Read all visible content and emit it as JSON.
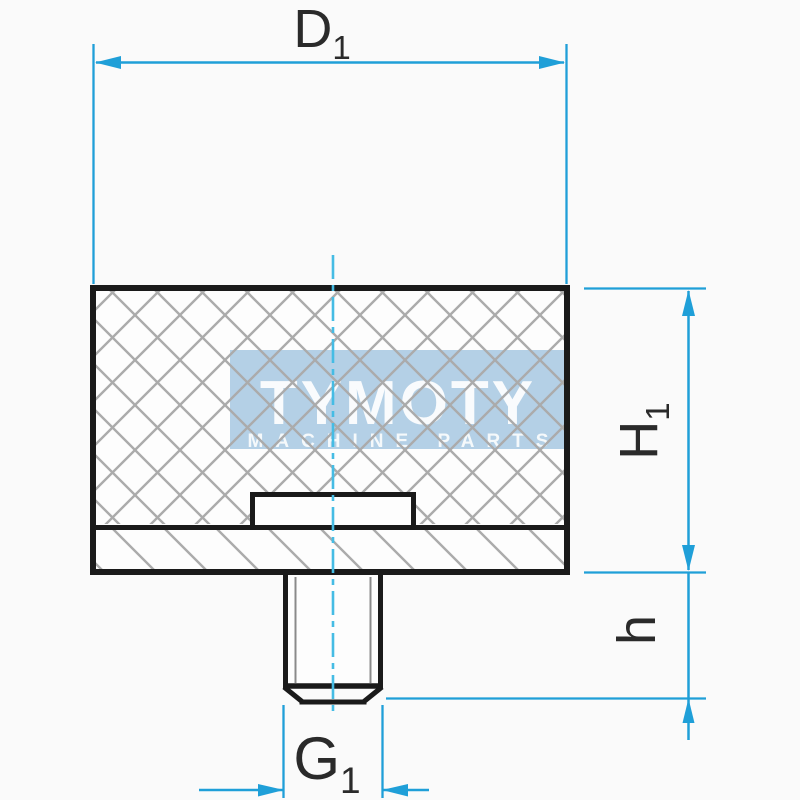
{
  "labels": {
    "diameter_top": {
      "base": "D",
      "sub": "1"
    },
    "height_total": {
      "base": "H",
      "sub": "1"
    },
    "stud_length": {
      "base": "h",
      "sub": ""
    },
    "thread_diameter": {
      "base": "G",
      "sub": "1"
    }
  },
  "watermark": {
    "title": "TYMOTY",
    "subtitle": "MACHINE PARTS"
  },
  "colors": {
    "background": "#fafafa",
    "body_fill": "#fdfdfd",
    "outline": "#1a1a1a",
    "hatch": "#ababab",
    "thread": "#8a8a8a",
    "dimension": "#1f9fd8",
    "centerline": "#45bce4",
    "label": "#2a2a2a",
    "watermark_bg": "#b4d0e6",
    "watermark_text": "#ffffff"
  }
}
